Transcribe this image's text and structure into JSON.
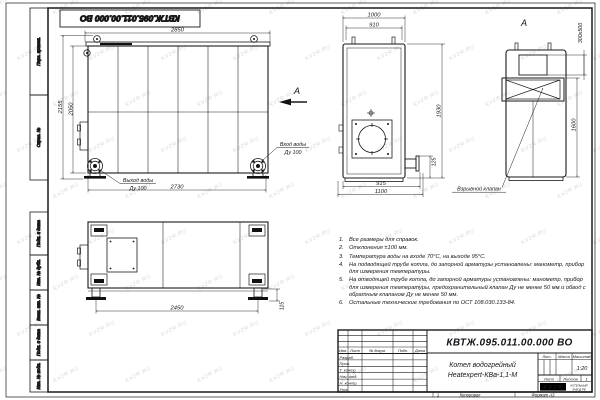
{
  "page": {
    "watermark": "KVZR.RU",
    "stamp_top": "КВТЖ.095.011.00.000 ВО",
    "footer_num": "1",
    "footer_copy": "Копировал",
    "footer_format": "Формат А3"
  },
  "frame": {
    "left_labels": [
      "Перв. примен.",
      "Справ. №",
      "Подп. и дата",
      "Инв. № дубл.",
      "Взам. инв. №",
      "Подп. и дата",
      "Инв. № подл."
    ]
  },
  "front_view": {
    "dim_top": "2850",
    "dim_bottom": "2730",
    "dim_height_outer": "2155",
    "dim_height_inner": "2050",
    "outlet_line1": "Выход воды",
    "outlet_line2": "Ду 100",
    "inlet_line1": "Вход воды",
    "inlet_line2": "Ду 100",
    "view_arrow_label": "А"
  },
  "side_view": {
    "dim_top_outer": "1000",
    "dim_top_inner": "910",
    "dim_height": "1930",
    "dim_stub": "125",
    "dim_bottom_inner": "915",
    "dim_bottom_outer": "1100"
  },
  "view_a": {
    "label": "А",
    "dim_flue": "300х500",
    "dim_height": "1600",
    "callout": "Взрывной клапан"
  },
  "bottom_view": {
    "dim_width": "2450",
    "dim_foot": "115"
  },
  "notes": [
    {
      "n": "1.",
      "t": "Все размеры для справок."
    },
    {
      "n": "2.",
      "t": "Отклонения ±100 мм."
    },
    {
      "n": "3.",
      "t": "Температура воды на входе 70°С, на выходе 95°С."
    },
    {
      "n": "4.",
      "t": "На подводящей трубе котла, до запорной арматуры установлены: манометр, прибор для измерения температуры."
    },
    {
      "n": "5.",
      "t": "На отводящей трубе котла, до запорной арматуры установлены: манометр, прибор для измерения температуры, предохранительный клапан Ду не менее 50 мм и обвод с обратным клапаном Ду не менее 50 мм."
    },
    {
      "n": "6.",
      "t": "Остальные технические требования по ОСТ 108.030.133-84."
    }
  ],
  "title_block": {
    "designation": "КВТЖ.095.011.00.000 ВО",
    "name_line1": "Котел водогрейный",
    "name_line2": "Heatexpert-КВа-1,1-М",
    "col_izm": "Изм.",
    "col_list": "Лист",
    "col_doc": "№ докум.",
    "col_sign": "Подп.",
    "col_date": "Дата",
    "roles": [
      "Разраб.",
      "Пров.",
      "Т. контр.",
      "Нач. отд.",
      "Н. контр.",
      "Утв."
    ],
    "lit_label": "Лит.",
    "mass_label": "Масса",
    "scale_label": "Масштаб",
    "scale_value": "1:20",
    "sheet_label": "Лист",
    "sheets_label": "Листов",
    "sheets_value": "1",
    "logo_text": "KVZR",
    "logo_caption1": "КОТЕЛЬНЫЙ",
    "logo_caption2": "ЗАВОД РФ"
  }
}
